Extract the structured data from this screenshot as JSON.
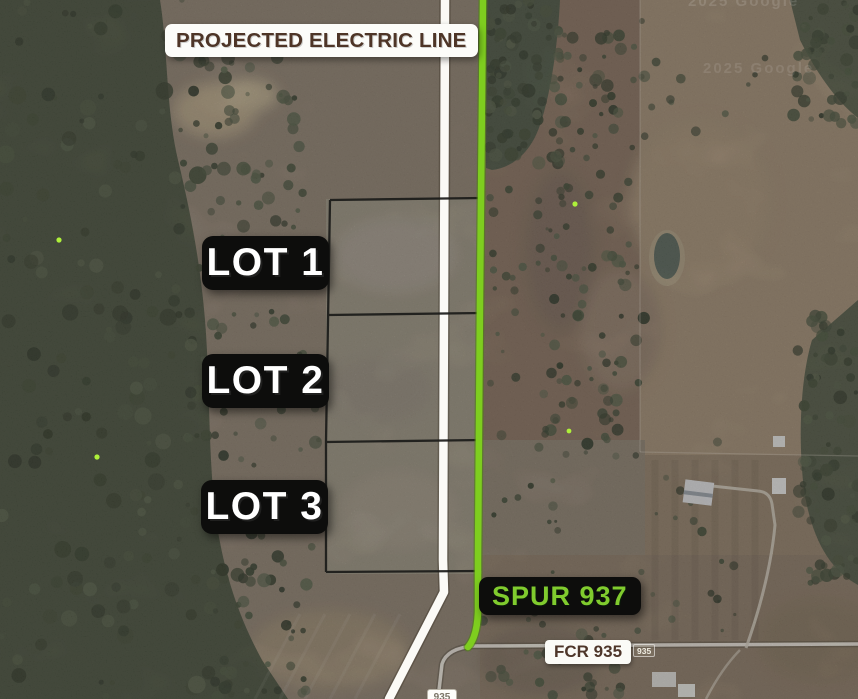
{
  "labels": {
    "electric_line": "PROJECTED ELECTRIC LINE",
    "lots": [
      "LOT 1",
      "LOT 2",
      "LOT 3"
    ],
    "spur": "SPUR 937",
    "fcr": "FCR 935",
    "shield": "935",
    "road_name_small": "935",
    "watermark": "2025 Google"
  },
  "colors": {
    "spur_green": "#7ecd1f",
    "electric_line_white": "#fbfaf6",
    "lot_boundary_black": "#1b1b19",
    "annotation_brown": "#4e3527",
    "label_box_black": "#0d0d0c"
  }
}
